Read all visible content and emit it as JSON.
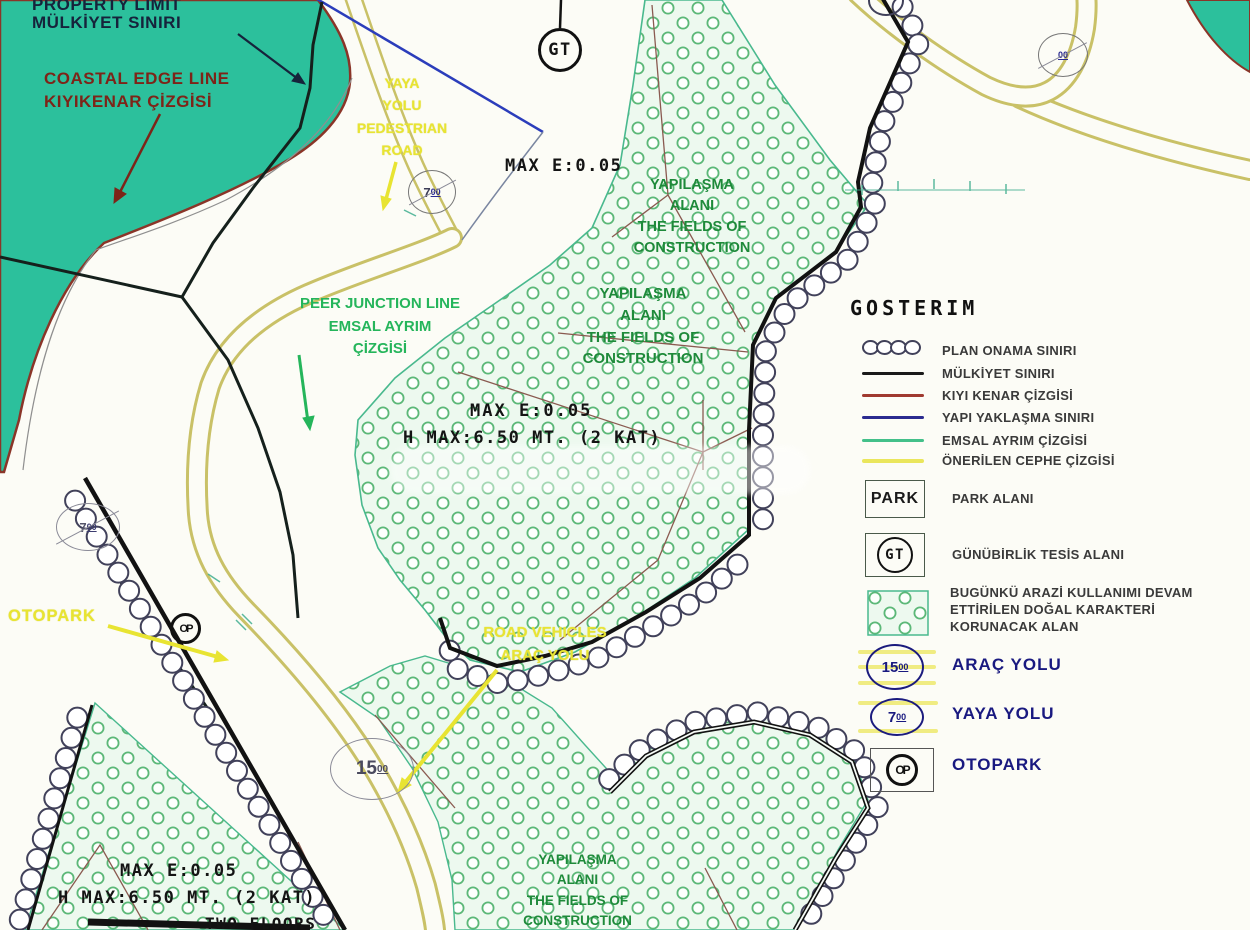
{
  "map": {
    "labels": {
      "property_limit": [
        "PROPERTY LIMIT",
        "MÜLKİYET SINIRI"
      ],
      "coastal_edge": [
        "COASTAL EDGE LINE",
        "KIYIKENAR ÇİZGİSİ"
      ],
      "pedestrian_road": [
        "YAYA",
        "YOLU",
        "PEDESTRIAN",
        "ROAD"
      ],
      "max_e_top": "MAX E:0.05",
      "construction_1": [
        "YAPILAŞMA",
        "ALANI",
        "THE FIELDS OF",
        "CONSTRUCTION"
      ],
      "construction_2": [
        "YAPILAŞMA",
        "ALANI",
        "THE FIELDS OF",
        "CONSTRUCTION"
      ],
      "peer_junction": [
        "PEER JUNCTION LINE",
        "EMSAL AYRIM",
        "ÇİZGİSİ"
      ],
      "max_e_mid": "MAX E:0.05",
      "h_max_mid": "H MAX:6.50 MT. (2 KAT)",
      "otopark": "OTOPARK",
      "road_vehicles": [
        "ROAD VEHICLES",
        "ARAÇ YOLU"
      ],
      "max_e_bottom": "MAX E:0.05",
      "h_max_bottom": "H MAX:6.50 MT. (2 KAT)",
      "two_floors": "TWO FLOORS",
      "construction_3": [
        "YAPILAŞMA",
        "ALANI",
        "THE FIELDS OF",
        "CONSTRUCTION"
      ]
    },
    "symbols": {
      "gt": "GT",
      "op": "OP",
      "road7_num": "7",
      "road15_num": "15",
      "road_dec": "00"
    }
  },
  "legend": {
    "title": "GOSTERIM",
    "items": [
      {
        "symbol": "plan-approval-circles",
        "label": "PLAN ONAMA SINIRI",
        "color": "#41415a"
      },
      {
        "symbol": "line",
        "label": "MÜLKİYET SINIRI",
        "color": "#1a1a1a"
      },
      {
        "symbol": "line",
        "label": "KIYI KENAR ÇİZGİSİ",
        "color": "#a03a30"
      },
      {
        "symbol": "line",
        "label": "YAPI YAKLAŞMA SINIRI",
        "color": "#2b2b90"
      },
      {
        "symbol": "line",
        "label": "EMSAL AYRIM ÇİZGİSİ",
        "color": "#43c08a"
      },
      {
        "symbol": "line",
        "label": "ÖNERİLEN CEPHE ÇİZGİSİ",
        "color": "#eae65c"
      }
    ],
    "park": {
      "symbol": "PARK",
      "label": "PARK ALANI"
    },
    "gt": {
      "symbol": "GT",
      "label": "GÜNÜBİRLİK TESİS ALANI"
    },
    "natural_area": {
      "label_lines": [
        "BUGÜNKÜ ARAZİ KULLANIMI DEVAM",
        "ETTİRİLEN DOĞAL KARAKTERİ",
        "KORUNACAK ALAN"
      ]
    },
    "arac_yolu": {
      "num": "15",
      "dec": "00",
      "label": "ARAÇ YOLU"
    },
    "yaya_yolu": {
      "num": "7",
      "dec": "00",
      "label": "YAYA YOLU"
    },
    "otopark": {
      "symbol": "OP",
      "label": "OTOPARK"
    }
  },
  "colors": {
    "sea_teal": "#2cc09c",
    "coastal_red": "#8a3528",
    "road_yellow": "#c9c167",
    "boundary_black": "#121212",
    "approach_blue": "#2b3dbb",
    "dots_green": "#5cb878",
    "area_tint": "#edf9ef",
    "legend_navy": "#191980",
    "label_green": "#1e8a3a",
    "label_bright_green": "#25b55b",
    "label_yellow": "#e8e432",
    "label_dark_red": "#7d2418"
  }
}
